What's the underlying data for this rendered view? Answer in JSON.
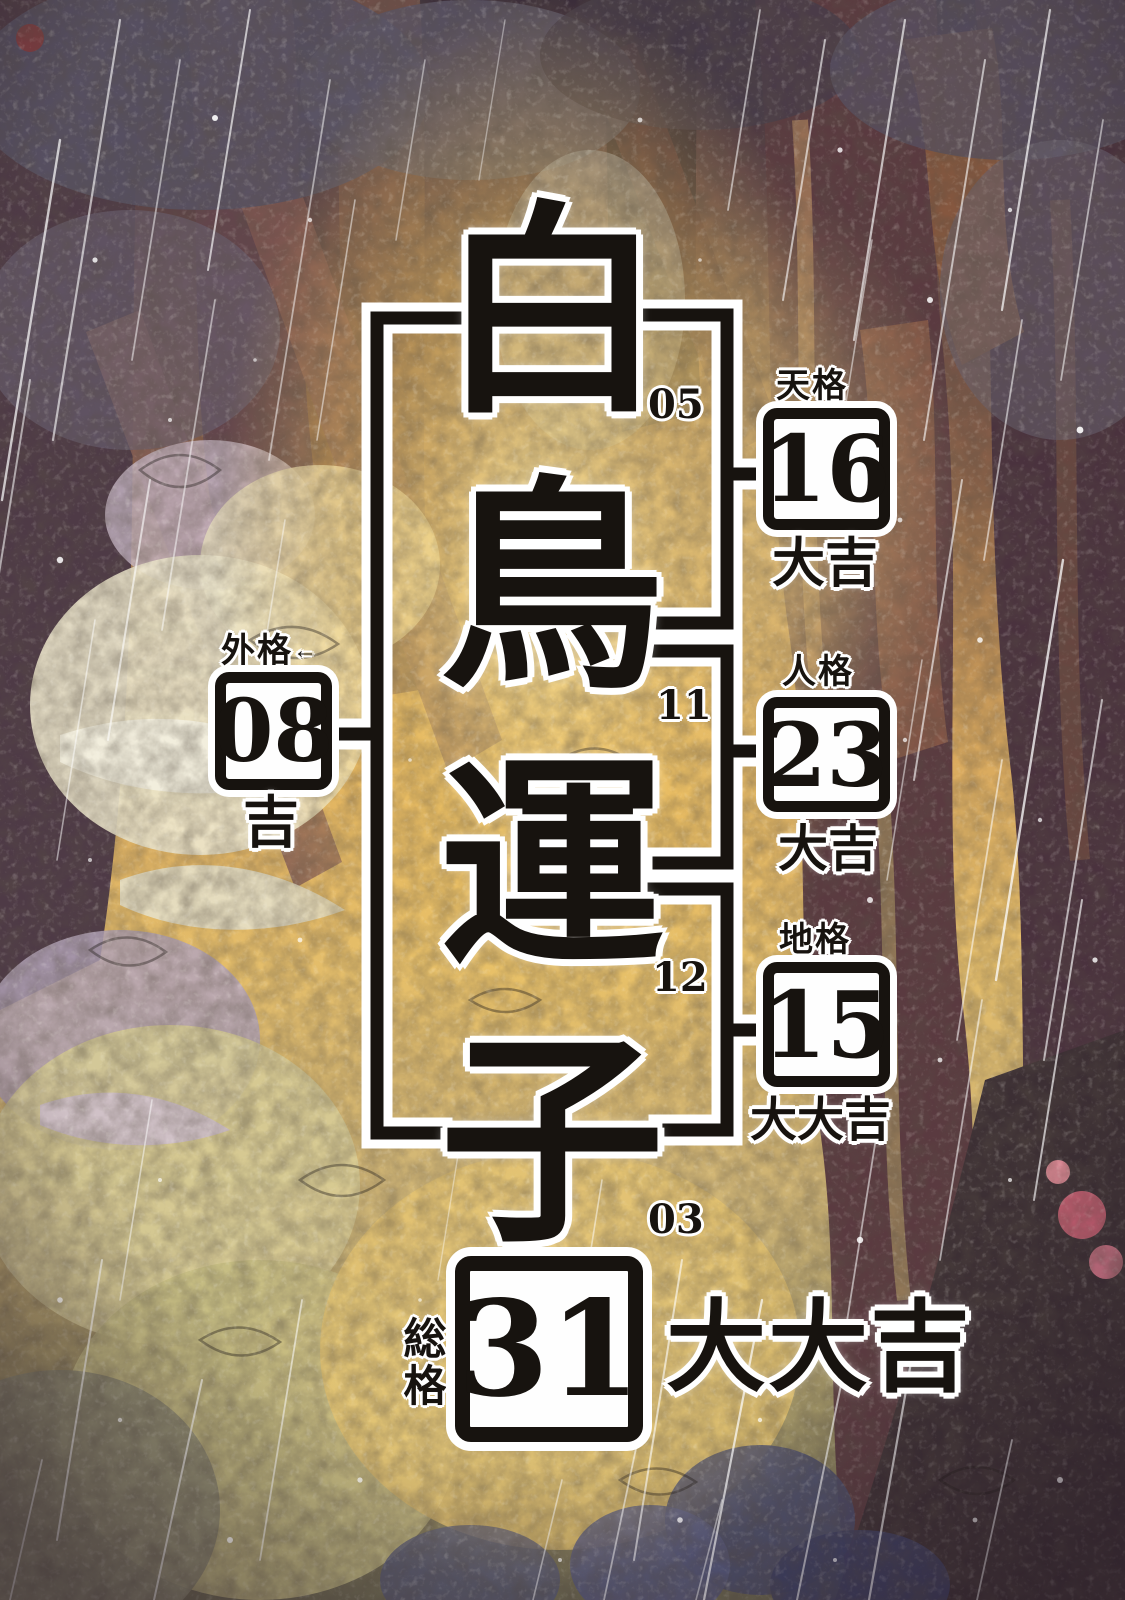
{
  "name_analysis": {
    "characters": [
      {
        "char": "白",
        "stroke_count": "05"
      },
      {
        "char": "鳥",
        "stroke_count": "11"
      },
      {
        "char": "運",
        "stroke_count": "12"
      },
      {
        "char": "子",
        "stroke_count": "03"
      }
    ],
    "categories": [
      {
        "key": "tenkaku",
        "label": "天格",
        "value": "16",
        "verdict": "大吉"
      },
      {
        "key": "jinkaku",
        "label": "人格",
        "value": "23",
        "verdict": "大吉"
      },
      {
        "key": "chikaku",
        "label": "地格",
        "value": "15",
        "verdict": "大大吉"
      },
      {
        "key": "gaikaku",
        "label": "外格",
        "arrow": "←",
        "value": "08",
        "verdict": "吉"
      },
      {
        "key": "soukaku",
        "label": "総格",
        "value": "31",
        "verdict": "大大吉"
      }
    ],
    "colors": {
      "ink": "#17130f",
      "halo": "#ffffff",
      "glow_gold": "#f3c963",
      "trunk_maroon": "#5a3a40"
    }
  }
}
